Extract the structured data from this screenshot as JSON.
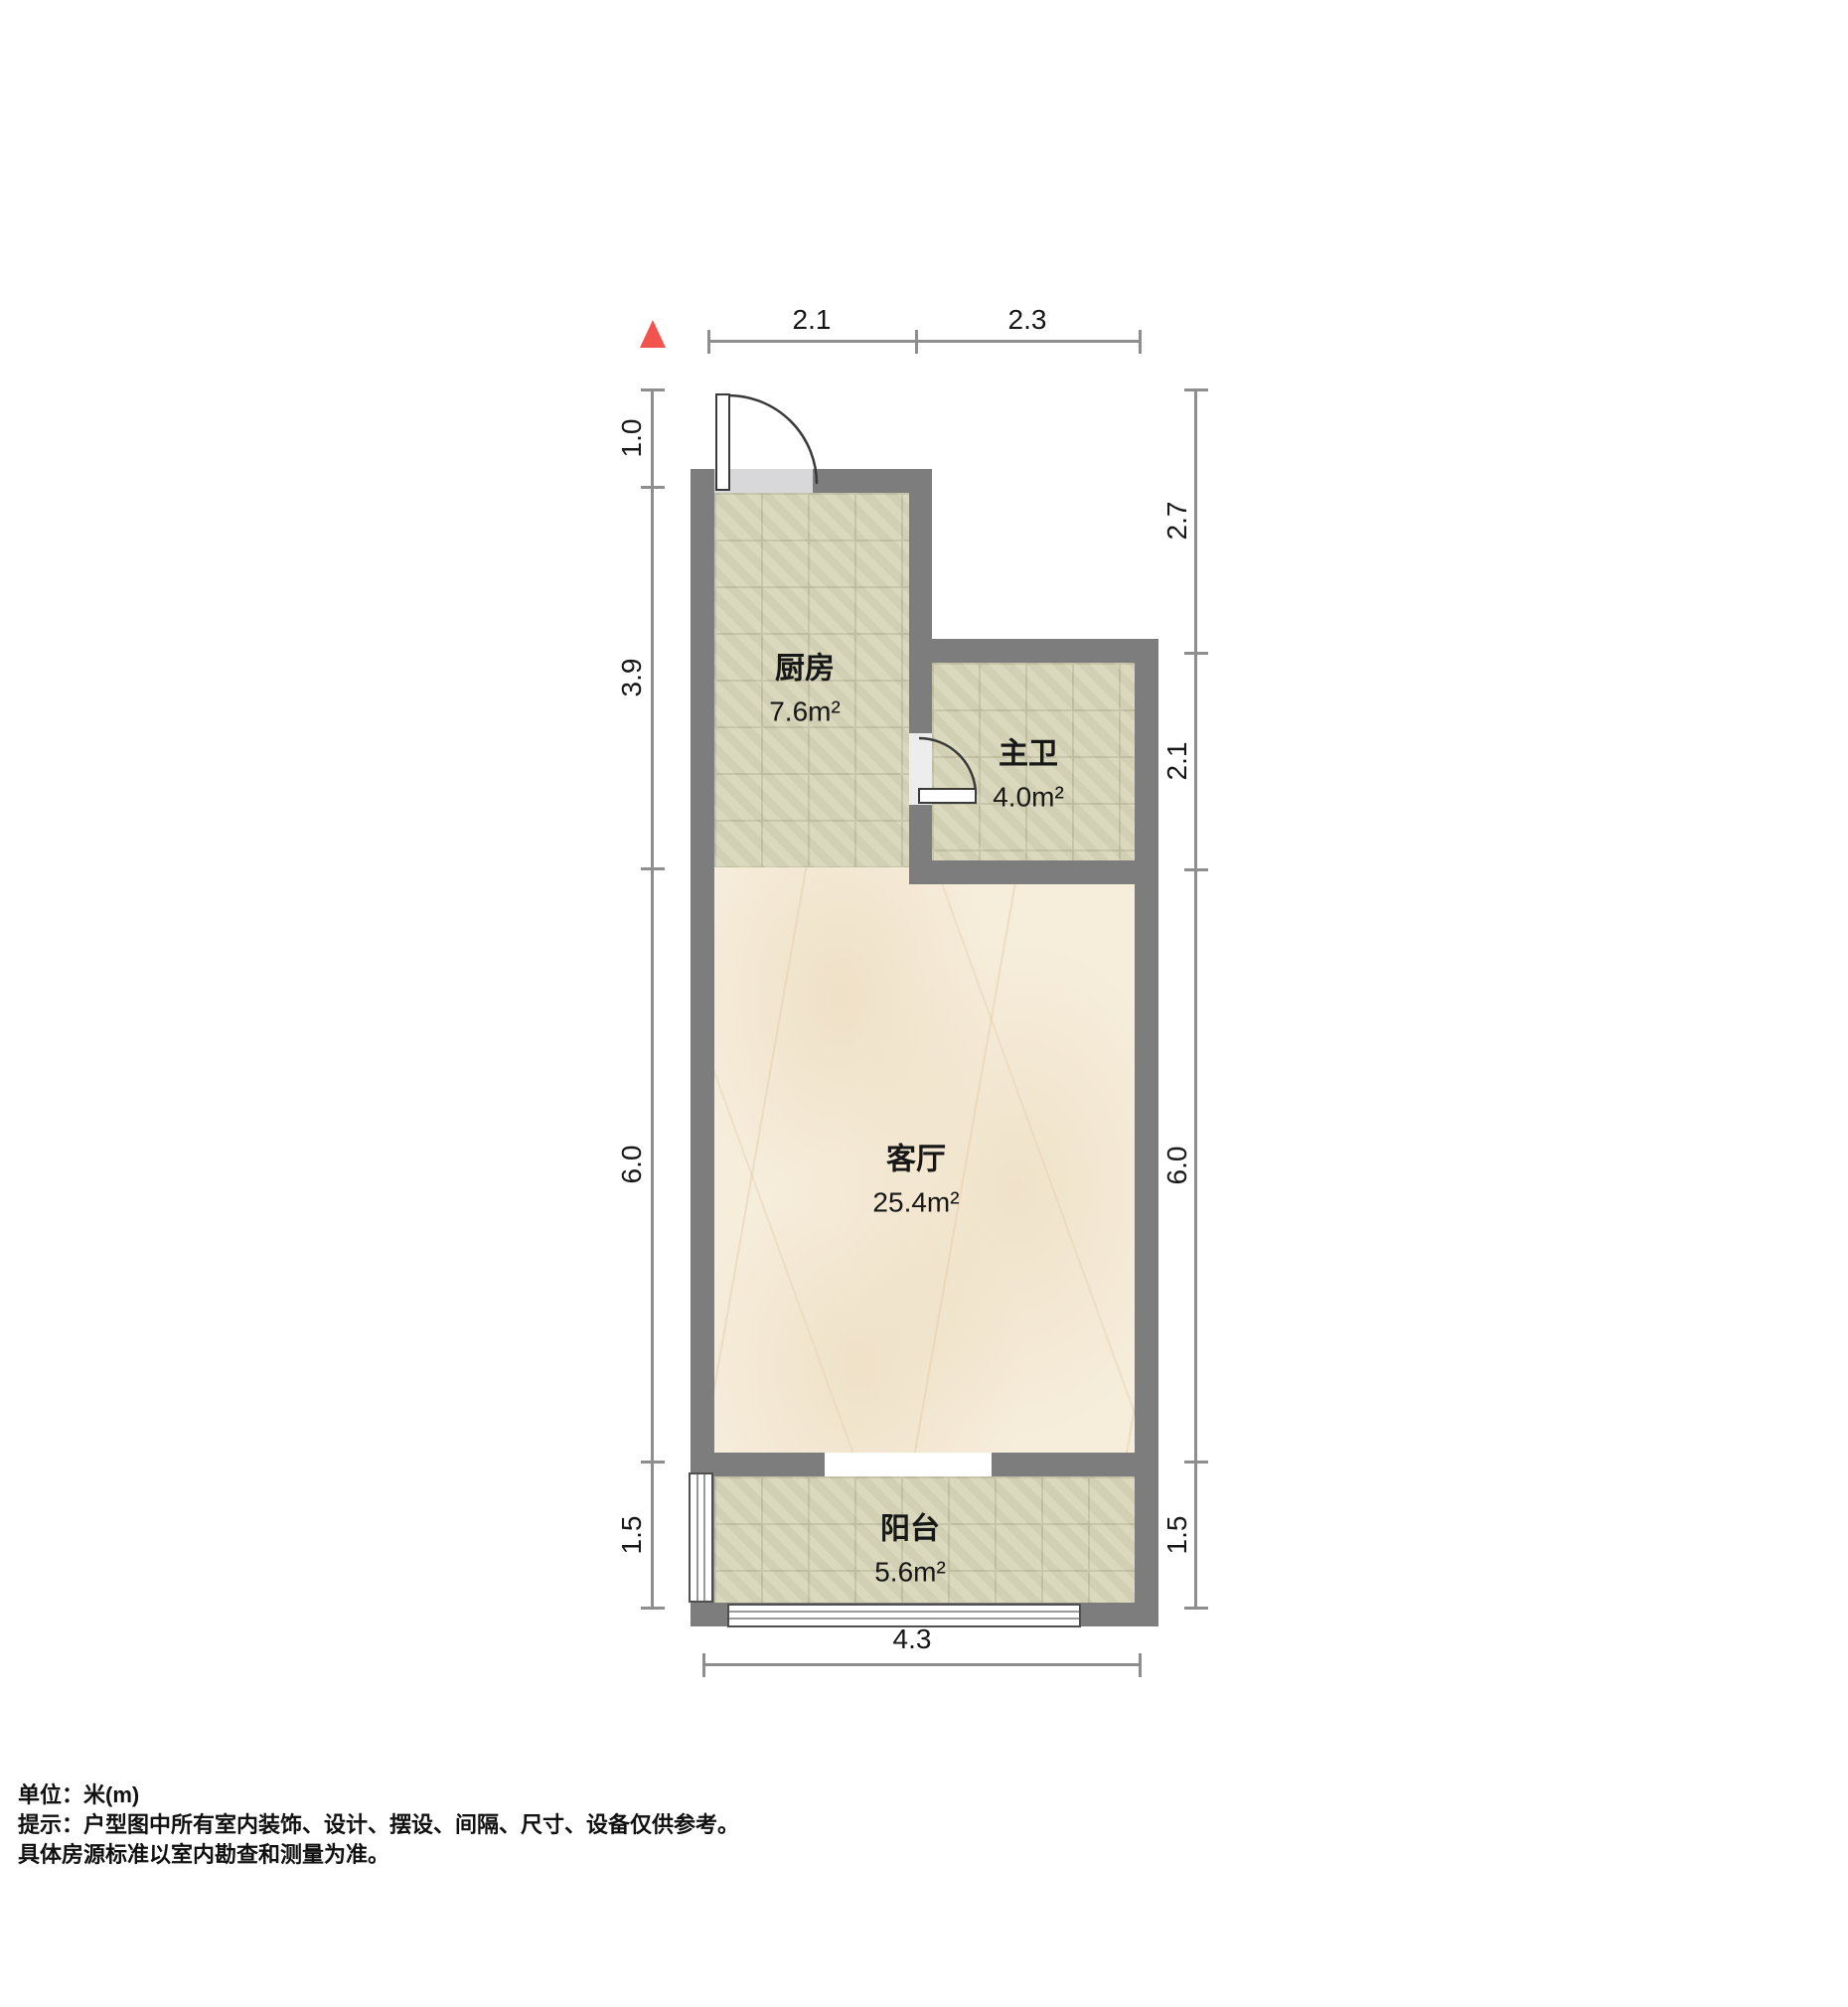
{
  "colors": {
    "wall": "#7d7d7d",
    "dim": "#8e8e8e",
    "tile": "#d7d6b9",
    "tile-grid": "#c2c1a4",
    "marble": "#f6eddb",
    "north": "#f3534e",
    "text": "#171717",
    "threshold": "#d8d8da",
    "door": "#3a3a3a",
    "window": "#4f4f4f"
  },
  "icons": {
    "north": "north-arrow-triangle",
    "entry_door": "door-swing-quarter-arc",
    "bathroom_door": "door-swing-quarter-arc",
    "balcony_side_window": "window-triple-line",
    "balcony_front_window": "window-sliding-lines"
  },
  "dims": {
    "top": [
      "2.1",
      "2.3"
    ],
    "left": [
      "1.0",
      "3.9",
      "6.0",
      "1.5"
    ],
    "right": [
      "2.7",
      "2.1",
      "6.0",
      "1.5"
    ],
    "bottom": [
      "4.3"
    ]
  },
  "rooms": {
    "kitchen": {
      "name": "厨房",
      "area": "7.6m²"
    },
    "bathroom": {
      "name": "主卫",
      "area": "4.0m²"
    },
    "living": {
      "name": "客厅",
      "area": "25.4m²"
    },
    "balcony": {
      "name": "阳台",
      "area": "5.6m²"
    }
  },
  "footer": {
    "unit": "单位：米(m)",
    "notice_line1": "提示：户型图中所有室内装饰、设计、摆设、间隔、尺寸、设备仅供参考。",
    "notice_line2": "具体房源标准以室内勘查和测量为准。"
  }
}
